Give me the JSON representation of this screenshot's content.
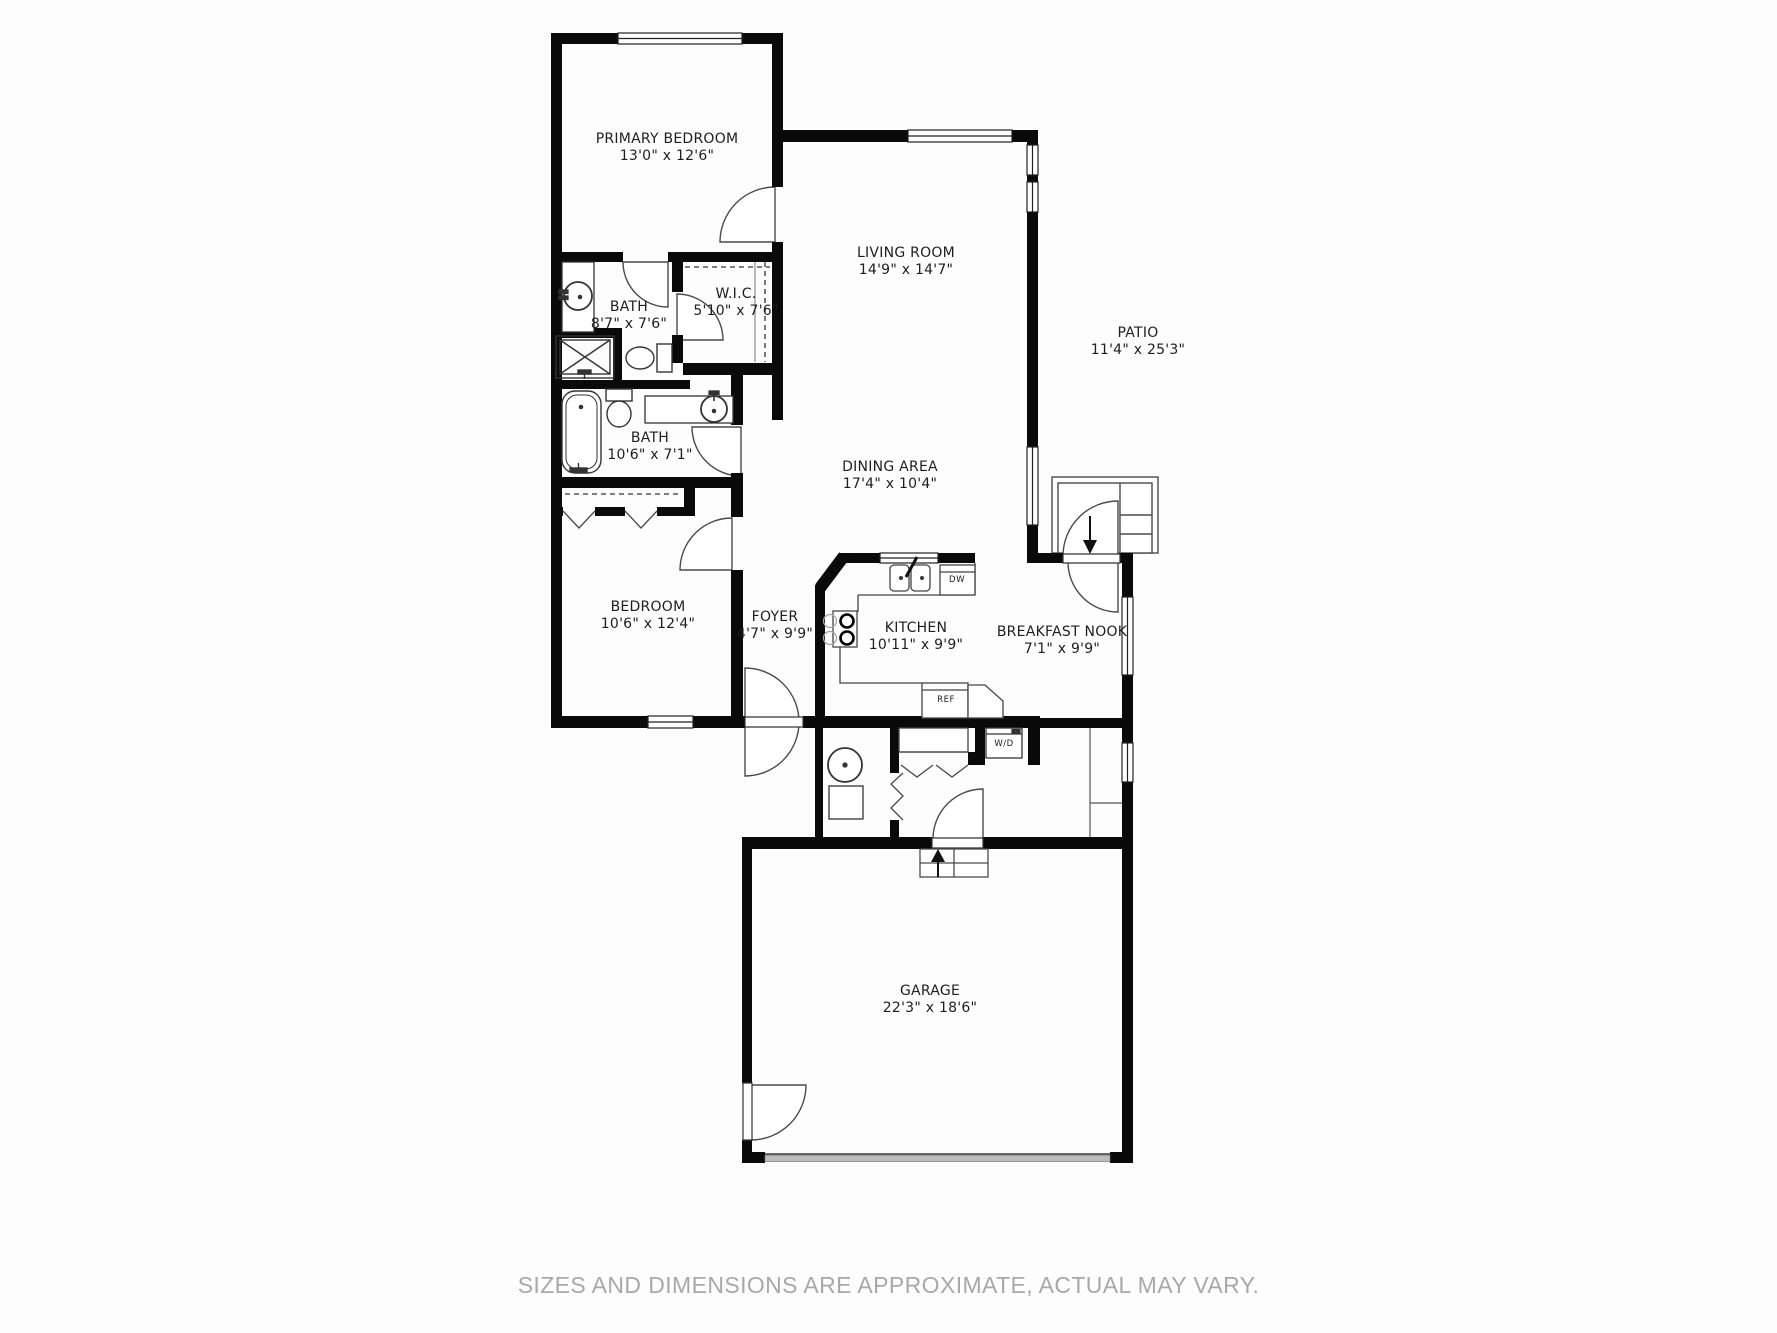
{
  "colors": {
    "walls": "#0a0a0a",
    "lines": "#3f3f3f",
    "thin": "#555555",
    "label": "#1e1e1e",
    "muted": "#a8a8a8",
    "bg": "#fdfdfd",
    "door-gray": "#bdbdbd"
  },
  "rooms": [
    {
      "id": "primary-bedroom",
      "name": "PRIMARY BEDROOM",
      "dims": "13'0\" x 12'6\""
    },
    {
      "id": "living-room",
      "name": "LIVING ROOM",
      "dims": "14'9\" x 14'7\""
    },
    {
      "id": "patio",
      "name": "PATIO",
      "dims": "11'4\" x 25'3\""
    },
    {
      "id": "bath-1",
      "name": "BATH",
      "dims": "8'7\" x 7'6\""
    },
    {
      "id": "wic",
      "name": "W.I.C.",
      "dims": "5'10\" x 7'6\""
    },
    {
      "id": "bath-2",
      "name": "BATH",
      "dims": "10'6\" x 7'1\""
    },
    {
      "id": "dining-area",
      "name": "DINING AREA",
      "dims": "17'4\" x 10'4\""
    },
    {
      "id": "bedroom",
      "name": "BEDROOM",
      "dims": "10'6\" x 12'4\""
    },
    {
      "id": "foyer",
      "name": "FOYER",
      "dims": "4'7\" x 9'9\""
    },
    {
      "id": "kitchen",
      "name": "KITCHEN",
      "dims": "10'11\" x 9'9\""
    },
    {
      "id": "breakfast-nook",
      "name": "BREAKFAST NOOK",
      "dims": "7'1\" x 9'9\""
    },
    {
      "id": "garage",
      "name": "GARAGE",
      "dims": "22'3\" x 18'6\""
    }
  ],
  "appliances": {
    "ref": "REF",
    "dw": "DW",
    "wd": "W/D"
  },
  "footer": {
    "disclaimer": "SIZES AND DIMENSIONS ARE APPROXIMATE, ACTUAL MAY VARY."
  }
}
